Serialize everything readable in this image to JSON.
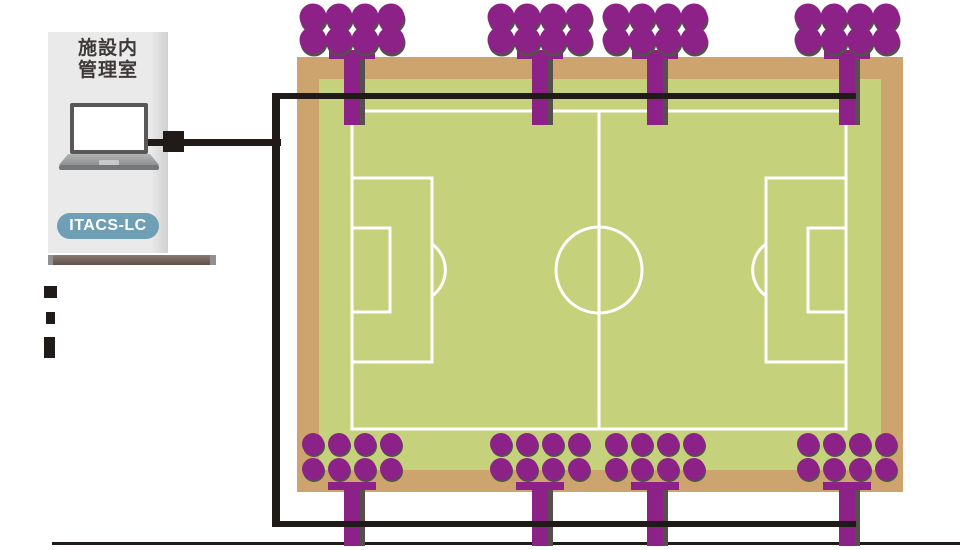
{
  "panel": {
    "title_line1": "施設内",
    "title_line2": "管理室",
    "device_badge": "ITACS-LC"
  },
  "floodlights": {
    "top_positions_x": [
      352,
      540,
      655,
      847
    ],
    "bottom_positions_x": [
      352,
      540,
      655,
      847
    ],
    "fixtures_top_count": 4,
    "fixtures_bottom_count": 4,
    "lamps_per_fixture": 8,
    "lamp_rows": 2,
    "lamp_cols": 4
  },
  "colors": {
    "floodlight_purple": "#8c2287",
    "shadow_gray": "#55504c",
    "field_tan": "#cda46e",
    "field_green": "#c5d17b",
    "field_line_white": "#ffffff",
    "cable_black": "#201b18",
    "badge_blue": "#6f9fb5",
    "panel_gray": "#eaeaea",
    "desk_brown": "#6f6056",
    "laptop_gray": "#595757"
  }
}
